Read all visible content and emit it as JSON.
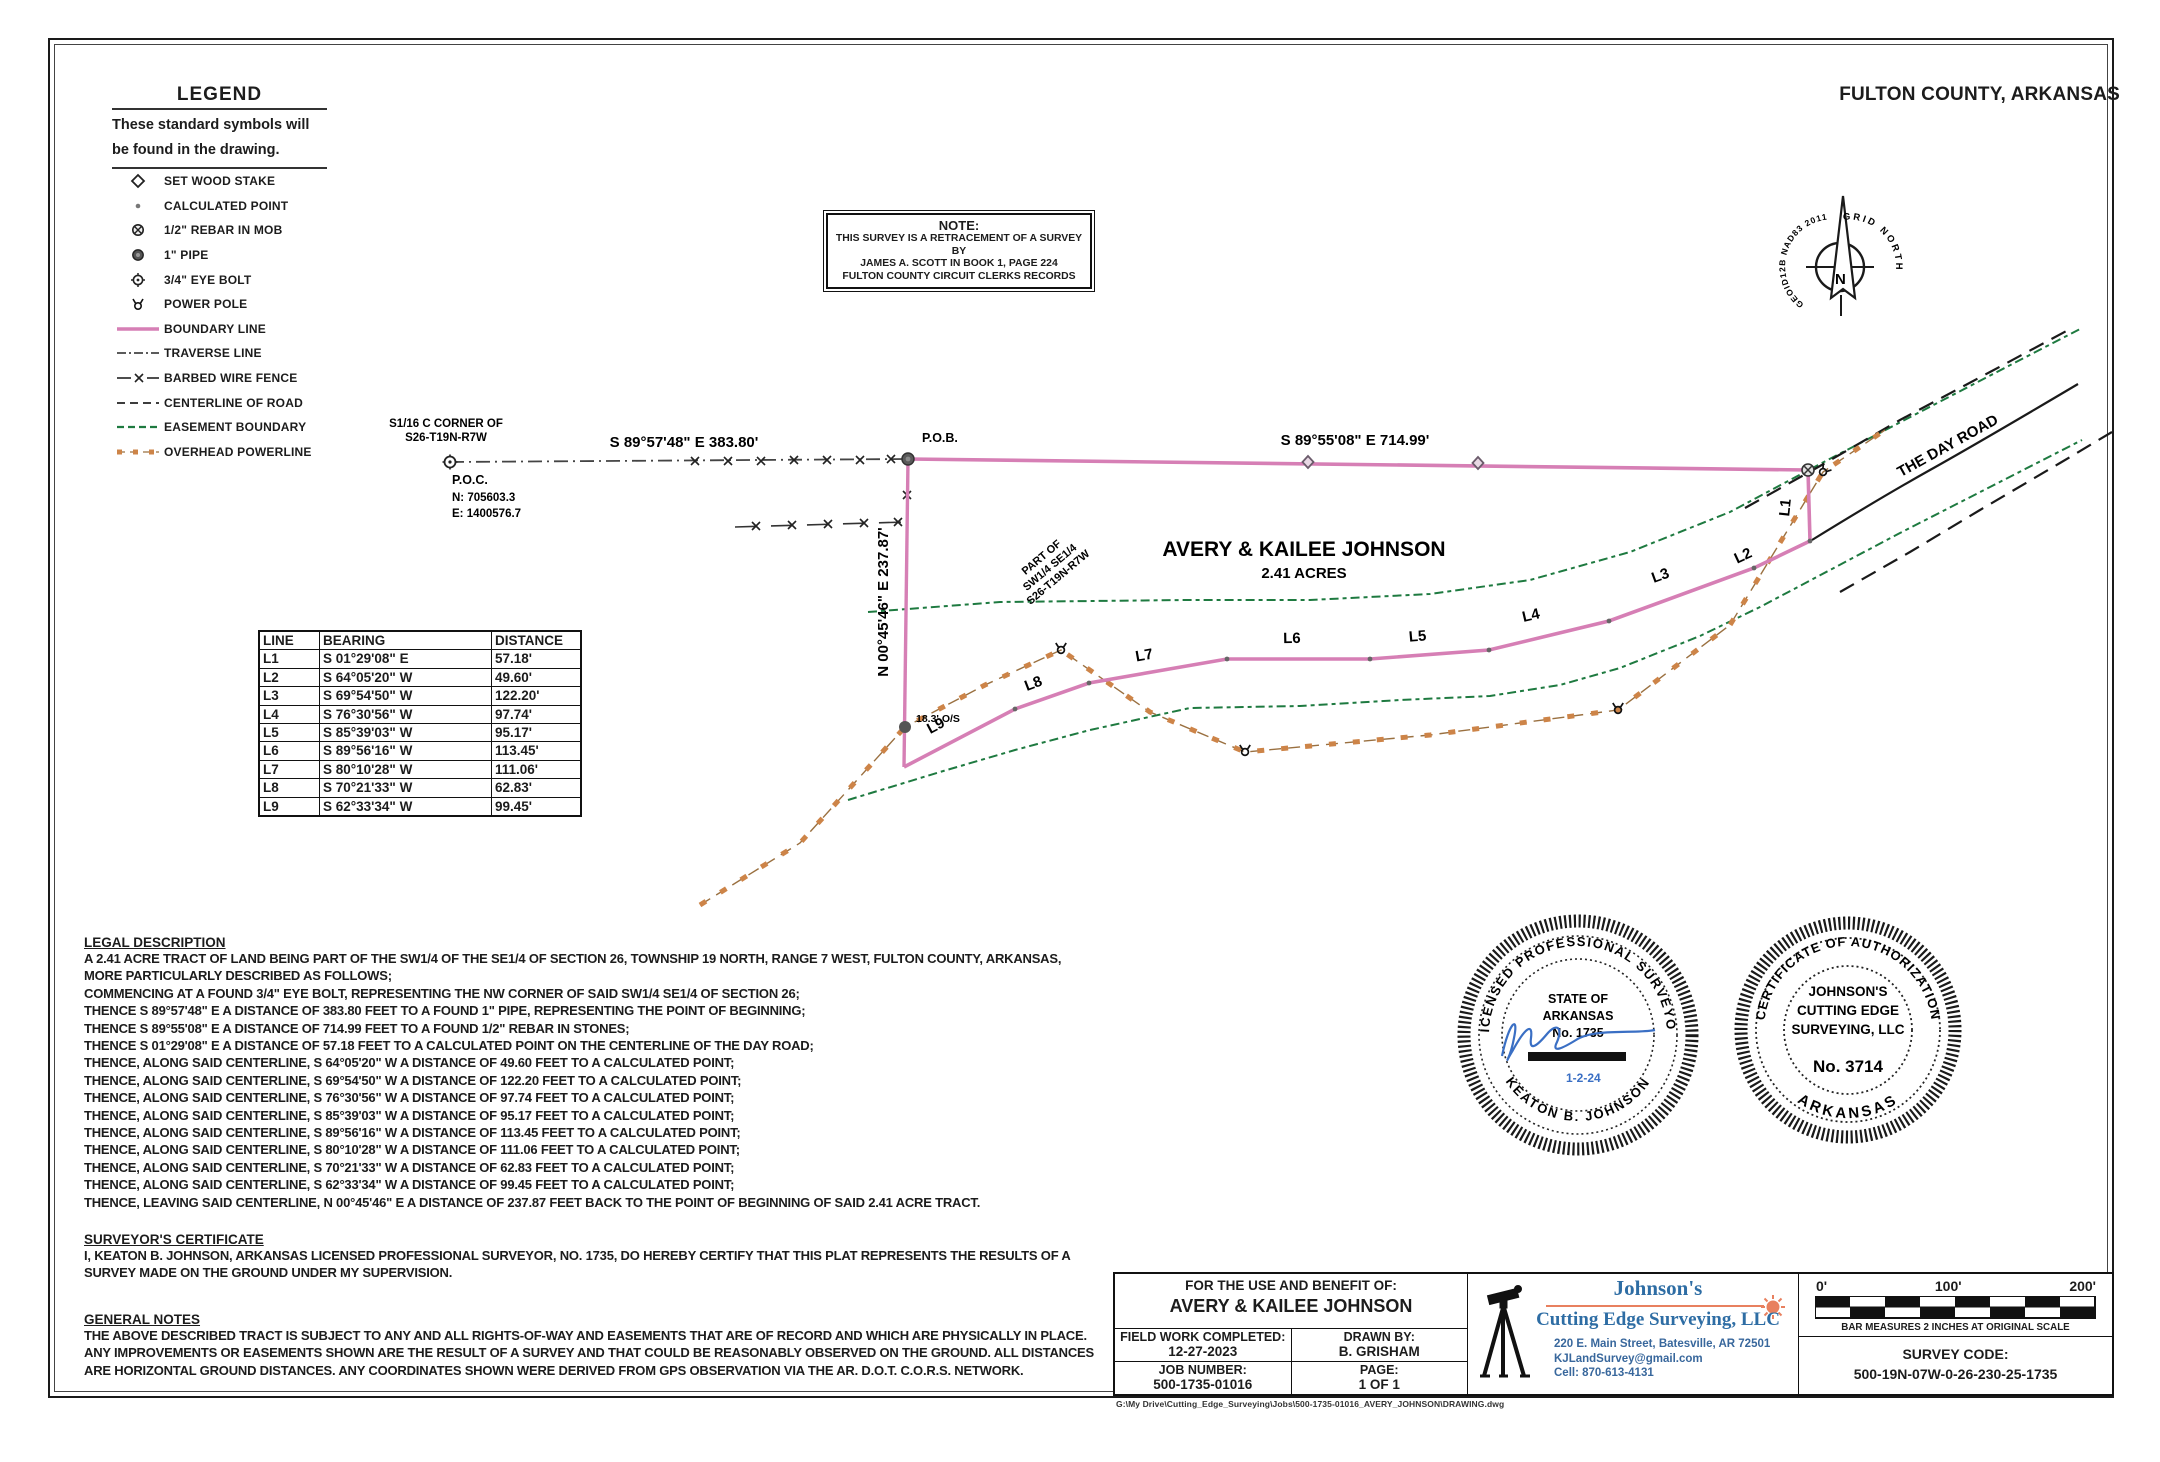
{
  "page": {
    "county": "FULTON COUNTY, ARKANSAS",
    "file_path": "G:\\My Drive\\Cutting_Edge_Surveying\\Jobs\\500-1735-01016_AVERY_JOHNSON\\DRAWING.dwg"
  },
  "legend": {
    "title": "LEGEND",
    "subtitle_line1": "These standard symbols will",
    "subtitle_line2": "be found in the drawing.",
    "items": [
      {
        "symbol": "wood-stake",
        "label": "SET WOOD STAKE"
      },
      {
        "symbol": "calculated-point",
        "label": "CALCULATED POINT"
      },
      {
        "symbol": "rebar",
        "label": "1/2\" REBAR IN MOB"
      },
      {
        "symbol": "pipe",
        "label": "1\" PIPE"
      },
      {
        "symbol": "eye-bolt",
        "label": "3/4\" EYE BOLT"
      },
      {
        "symbol": "power-pole",
        "label": "POWER POLE"
      },
      {
        "symbol": "boundary-line",
        "label": "BOUNDARY LINE"
      },
      {
        "symbol": "traverse-line",
        "label": "TRAVERSE LINE"
      },
      {
        "symbol": "barbed-wire-fence",
        "label": "BARBED WIRE FENCE"
      },
      {
        "symbol": "centerline-of-road",
        "label": "CENTERLINE OF ROAD"
      },
      {
        "symbol": "easement-boundary",
        "label": "EASEMENT BOUNDARY"
      },
      {
        "symbol": "overhead-powerline",
        "label": "OVERHEAD POWERLINE"
      }
    ]
  },
  "note_box": {
    "title": "NOTE:",
    "lines": [
      "THIS SURVEY IS A RETRACEMENT OF A SURVEY BY",
      "JAMES A. SCOTT IN BOOK 1, PAGE 224",
      "FULTON COUNTY CIRCUIT CLERKS RECORDS"
    ]
  },
  "north_arrow": {
    "left_label": "GEOID12B NAD83 2011",
    "right_label": "GRID NORTH",
    "n": "N"
  },
  "drawing": {
    "corner_label_line1": "S1/16 C CORNER OF",
    "corner_label_line2": "S26-T19N-R7W",
    "poc_label": "P.O.C.",
    "poc_northing": "N: 705603.3",
    "poc_easting": "E: 1400576.7",
    "pob_label": "P.O.B.",
    "bearing_west": "S 89°57'48\" E  383.80'",
    "bearing_east": "S 89°55'08\" E  714.99'",
    "owner": "AVERY & KAILEE JOHNSON",
    "acreage": "2.41 ACRES",
    "part_of": [
      "PART OF",
      "SW1/4 SE1/4",
      "S26-T19N-R7W"
    ],
    "west_line_label": "N 00°45'46\" E  237.87'",
    "offset_label": "18.3' O/S",
    "road_label": "THE DAY ROAD",
    "segment_labels": [
      "L1",
      "L2",
      "L3",
      "L4",
      "L5",
      "L6",
      "L7",
      "L8",
      "L9"
    ]
  },
  "line_table": {
    "headers": [
      "LINE",
      "BEARING",
      "DISTANCE"
    ],
    "rows": [
      {
        "line": "L1",
        "bearing": "S 01°29'08\"  E",
        "distance": "57.18'"
      },
      {
        "line": "L2",
        "bearing": "S 64°05'20\"  W",
        "distance": "49.60'"
      },
      {
        "line": "L3",
        "bearing": "S 69°54'50\"  W",
        "distance": "122.20'"
      },
      {
        "line": "L4",
        "bearing": "S 76°30'56\"  W",
        "distance": "97.74'"
      },
      {
        "line": "L5",
        "bearing": "S 85°39'03\"  W",
        "distance": "95.17'"
      },
      {
        "line": "L6",
        "bearing": "S 89°56'16\"  W",
        "distance": "113.45'"
      },
      {
        "line": "L7",
        "bearing": "S 80°10'28\"  W",
        "distance": "111.06'"
      },
      {
        "line": "L8",
        "bearing": "S 70°21'33\"  W",
        "distance": "62.83'"
      },
      {
        "line": "L9",
        "bearing": "S 62°33'34\"  W",
        "distance": "99.45'"
      }
    ]
  },
  "legal_description": {
    "heading": "LEGAL DESCRIPTION",
    "lines": [
      "A 2.41  ACRE TRACT OF LAND BEING PART OF THE SW1/4 OF THE SE1/4 OF SECTION 26, TOWNSHIP 19 NORTH, RANGE 7 WEST, FULTON COUNTY, ARKANSAS,",
      "MORE PARTICULARLY DESCRIBED AS FOLLOWS;",
      "COMMENCING AT A FOUND 3/4\" EYE BOLT, REPRESENTING THE NW CORNER OF SAID SW1/4 SE1/4 OF SECTION 26;",
      "THENCE S 89°57'48\" E A DISTANCE OF 383.80 FEET TO A FOUND 1\" PIPE, REPRESENTING THE POINT OF BEGINNING;",
      "THENCE S 89°55'08\" E A DISTANCE OF 714.99 FEET TO A FOUND 1/2\" REBAR IN STONES;",
      "THENCE S 01°29'08\" E A DISTANCE OF 57.18 FEET TO A CALCULATED POINT ON THE CENTERLINE OF THE DAY ROAD;",
      "THENCE, ALONG SAID CENTERLINE, S 64°05'20\" W A DISTANCE OF 49.60 FEET TO A CALCULATED POINT;",
      "THENCE, ALONG SAID CENTERLINE, S 69°54'50\" W A DISTANCE OF 122.20 FEET TO A CALCULATED POINT;",
      "THENCE, ALONG SAID CENTERLINE, S 76°30'56\" W A DISTANCE OF 97.74 FEET TO A CALCULATED POINT;",
      "THENCE, ALONG SAID CENTERLINE, S 85°39'03\" W A DISTANCE OF 95.17 FEET TO A CALCULATED POINT;",
      "THENCE, ALONG SAID CENTERLINE, S 89°56'16\" W A DISTANCE OF 113.45 FEET TO A CALCULATED POINT;",
      "THENCE, ALONG SAID CENTERLINE, S 80°10'28\" W A DISTANCE OF 111.06 FEET TO A CALCULATED POINT;",
      "THENCE, ALONG SAID CENTERLINE, S 70°21'33\" W A DISTANCE OF 62.83 FEET TO A CALCULATED POINT;",
      "THENCE, ALONG SAID CENTERLINE, S 62°33'34\" W A DISTANCE OF 99.45 FEET TO A CALCULATED POINT;",
      "THENCE, LEAVING SAID CENTERLINE, N 00°45'46\" E A DISTANCE OF 237.87 FEET BACK TO THE POINT OF BEGINNING OF SAID 2.41 ACRE TRACT."
    ]
  },
  "surveyors_certificate": {
    "heading": "SURVEYOR'S CERTIFICATE",
    "lines": [
      "I, KEATON B. JOHNSON, ARKANSAS LICENSED PROFESSIONAL SURVEYOR, NO. 1735, DO HEREBY CERTIFY THAT THIS PLAT REPRESENTS THE RESULTS OF A",
      "SURVEY MADE ON THE GROUND UNDER MY SUPERVISION."
    ]
  },
  "general_notes": {
    "heading": "GENERAL NOTES",
    "lines": [
      "THE ABOVE DESCRIBED TRACT IS SUBJECT TO ANY AND ALL RIGHTS-OF-WAY AND EASEMENTS THAT ARE OF RECORD AND WHICH ARE PHYSICALLY IN PLACE.",
      "ANY IMPROVEMENTS OR EASEMENTS SHOWN ARE THE RESULT OF A SURVEY AND THAT COULD BE REASONABLY OBSERVED ON THE GROUND. ALL DISTANCES",
      "ARE HORIZONTAL GROUND DISTANCES. ANY COORDINATES SHOWN WERE DERIVED FROM GPS OBSERVATION VIA THE AR. D.O.T. C.O.R.S. NETWORK."
    ]
  },
  "seals": {
    "surveyor": {
      "arc_top": "LICENSED  PROFESSIONAL  SURVEYOR",
      "arc_bottom": "KEATON B. JOHNSON",
      "line1": "STATE OF",
      "line2": "ARKANSAS",
      "line3": "No. 1735",
      "date": "1-2-24"
    },
    "authorization": {
      "arc_top": "CERTIFICATE OF AUTHORIZATION",
      "arc_bottom": "ARKANSAS",
      "line1": "JOHNSON'S",
      "line2": "CUTTING  EDGE",
      "line3": "SURVEYING,  LLC",
      "number": "No.  3714"
    }
  },
  "title_block": {
    "benefit_label": "FOR THE USE AND BENEFIT OF:",
    "benefit_name": "AVERY & KAILEE JOHNSON",
    "field_work_label": "FIELD WORK COMPLETED:",
    "field_work_value": "12-27-2023",
    "drawn_by_label": "DRAWN BY:",
    "drawn_by_value": "B. GRISHAM",
    "job_number_label": "JOB NUMBER:",
    "job_number_value": "500-1735-01016",
    "page_label": "PAGE:",
    "page_value": "1 OF 1"
  },
  "company": {
    "name_line1": "Johnson's",
    "name_line2": "Cutting Edge Surveying, LLC",
    "address": "220 E. Main Street, Batesville, AR 72501",
    "email": "KJLandSurvey@gmail.com",
    "phone": "Cell: 870-613-4131"
  },
  "scale_bar": {
    "tick_labels": [
      "0'",
      "100'",
      "200'"
    ],
    "note": "BAR MEASURES 2 INCHES AT ORIGINAL SCALE",
    "survey_code_label": "SURVEY CODE:",
    "survey_code": "500-19N-07W-0-26-230-25-1735"
  },
  "colors": {
    "boundary_pink": "#d67fb5",
    "easement_green": "#1e7a40",
    "powerline_orange": "#cd8448",
    "company_blue": "#2e6da4",
    "accent_orange": "#e8805f",
    "signature_blue": "#3a6fc4"
  }
}
